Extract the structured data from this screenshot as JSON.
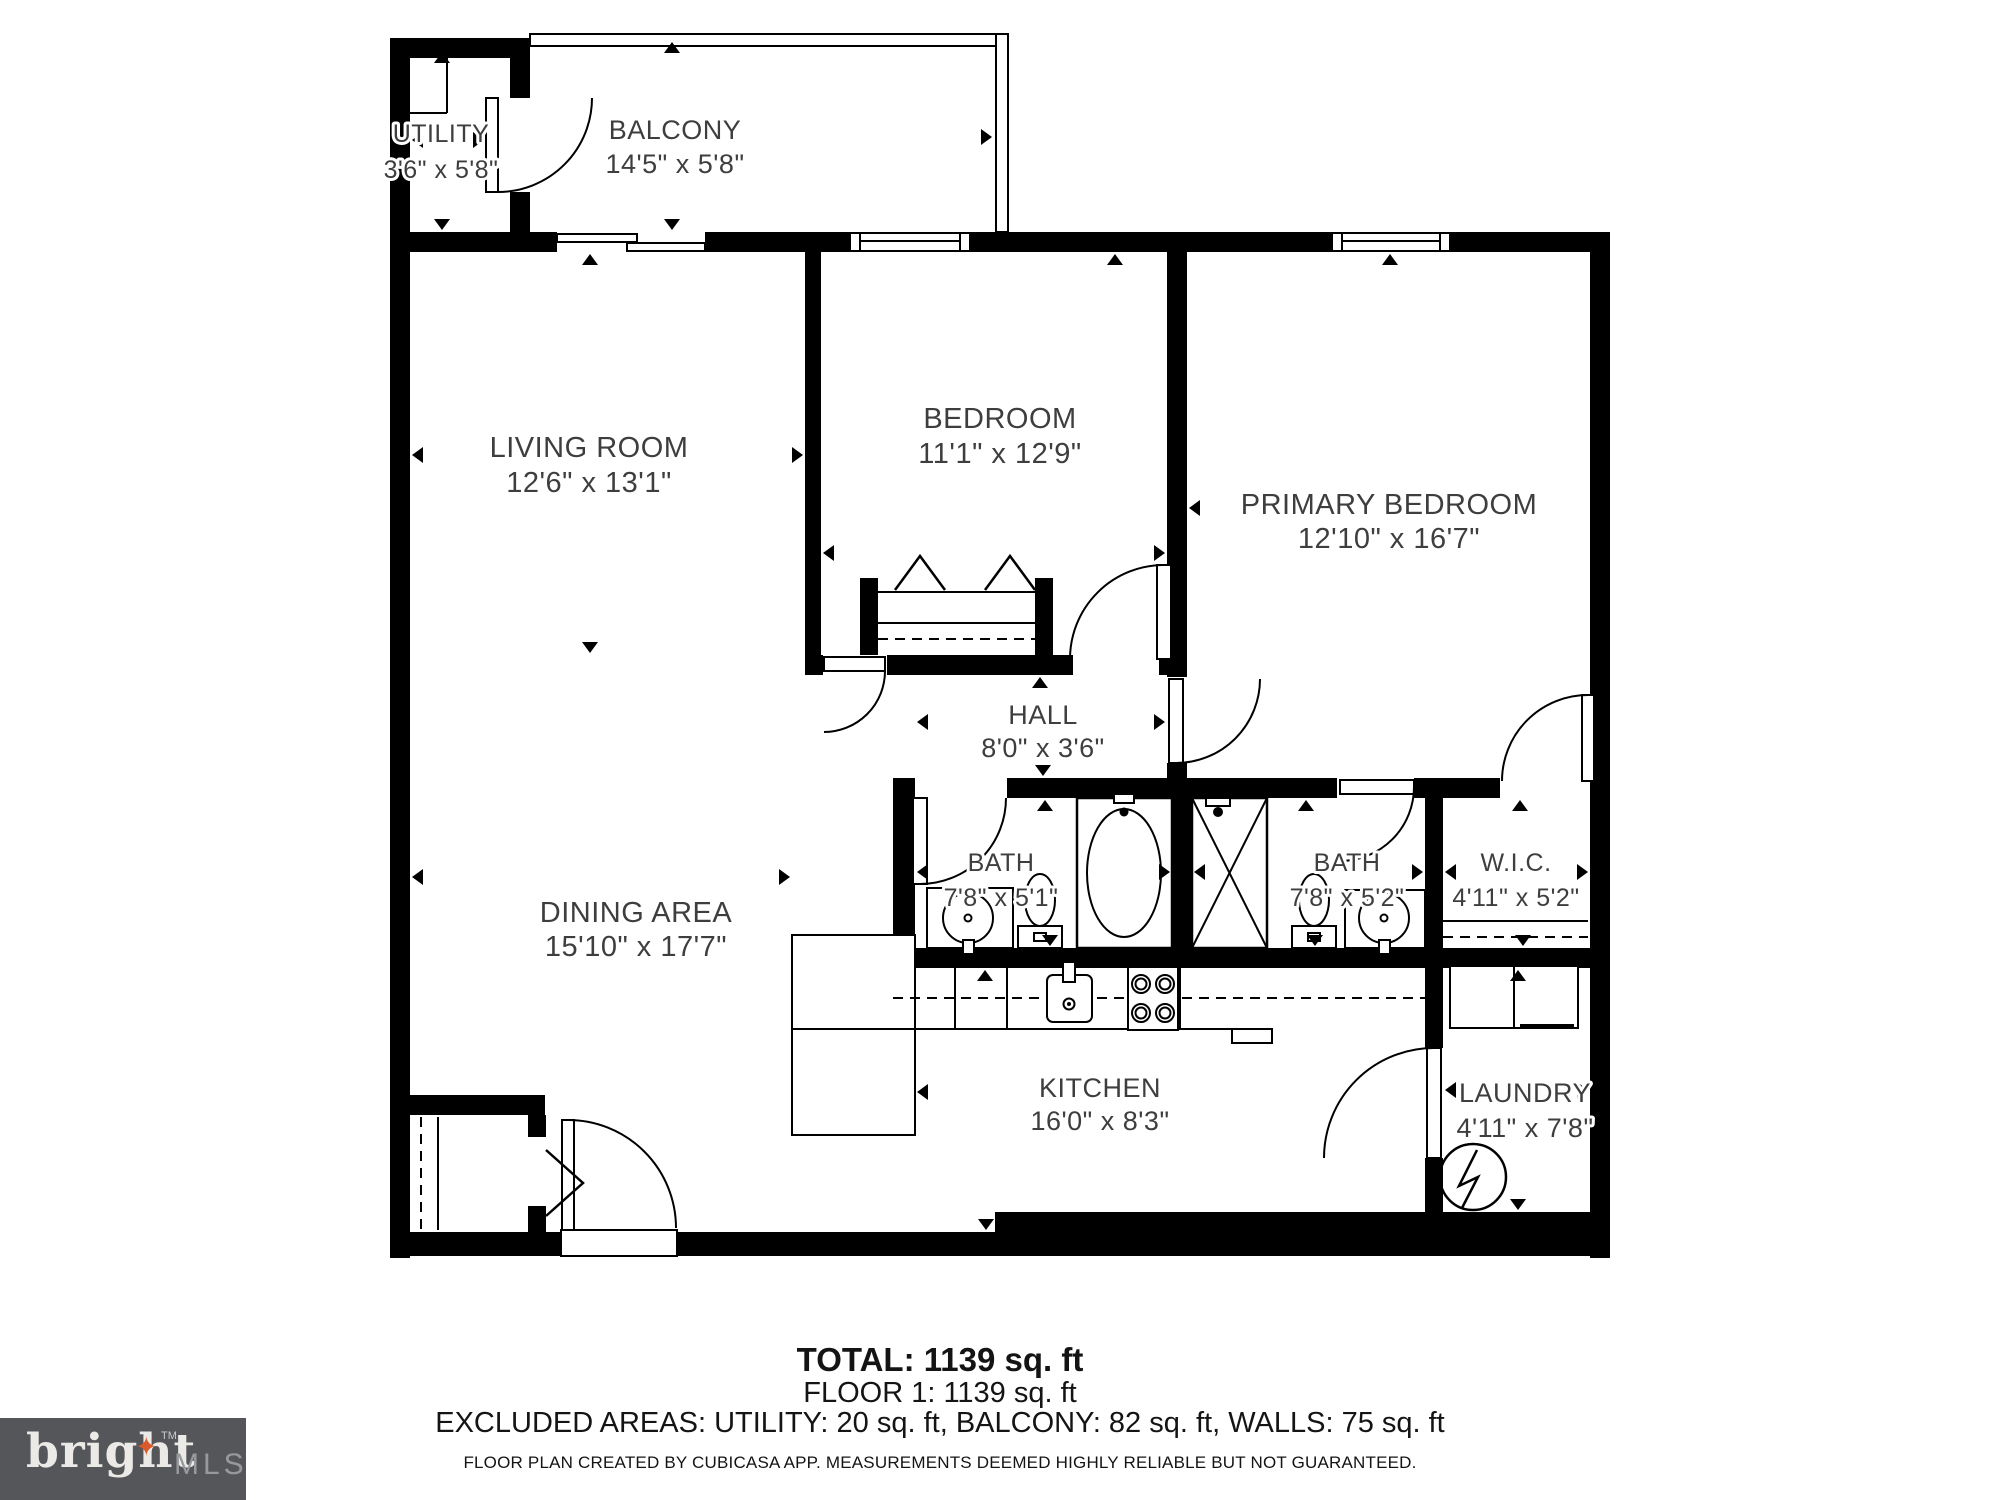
{
  "plan": {
    "rooms": [
      {
        "id": "utility",
        "name": "UTILITY",
        "dims": "3'6\" x 5'8\""
      },
      {
        "id": "balcony",
        "name": "BALCONY",
        "dims": "14'5\" x 5'8\""
      },
      {
        "id": "living-room",
        "name": "LIVING ROOM",
        "dims": "12'6\" x 13'1\""
      },
      {
        "id": "bedroom",
        "name": "BEDROOM",
        "dims": "11'1\" x 12'9\""
      },
      {
        "id": "primary-bedroom",
        "name": "PRIMARY BEDROOM",
        "dims": "12'10\" x 16'7\""
      },
      {
        "id": "hall",
        "name": "HALL",
        "dims": "8'0\" x 3'6\""
      },
      {
        "id": "bath-1",
        "name": "BATH",
        "dims": "7'8\" x 5'1\""
      },
      {
        "id": "bath-2",
        "name": "BATH",
        "dims": "7'8\" x 5'2\""
      },
      {
        "id": "wic",
        "name": "W.I.C.",
        "dims": "4'11\" x 5'2\""
      },
      {
        "id": "dining-area",
        "name": "DINING AREA",
        "dims": "15'10\" x 17'7\""
      },
      {
        "id": "kitchen",
        "name": "KITCHEN",
        "dims": "16'0\" x 8'3\""
      },
      {
        "id": "laundry",
        "name": "LAUNDRY",
        "dims": "4'11\" x 7'8\""
      }
    ]
  },
  "summary": {
    "total": "TOTAL: 1139 sq. ft",
    "floor": "FLOOR 1: 1139 sq. ft",
    "excluded": "EXCLUDED AREAS: UTILITY: 20 sq. ft, BALCONY: 82 sq. ft, WALLS: 75 sq. ft",
    "disclaimer": "FLOOR PLAN CREATED BY CUBICASA APP. MEASUREMENTS DEEMED HIGHLY RELIABLE BUT NOT GUARANTEED."
  },
  "logo": {
    "brand": "bright",
    "tm": "TM",
    "suffix": "MLS",
    "colors": {
      "bg": "#54565A",
      "brand": "#ECEAE7",
      "suffix": "#97999C",
      "star": "#DB5A2B"
    }
  },
  "colors": {
    "wall": "#000000",
    "label_text": "#3E3E3E"
  }
}
